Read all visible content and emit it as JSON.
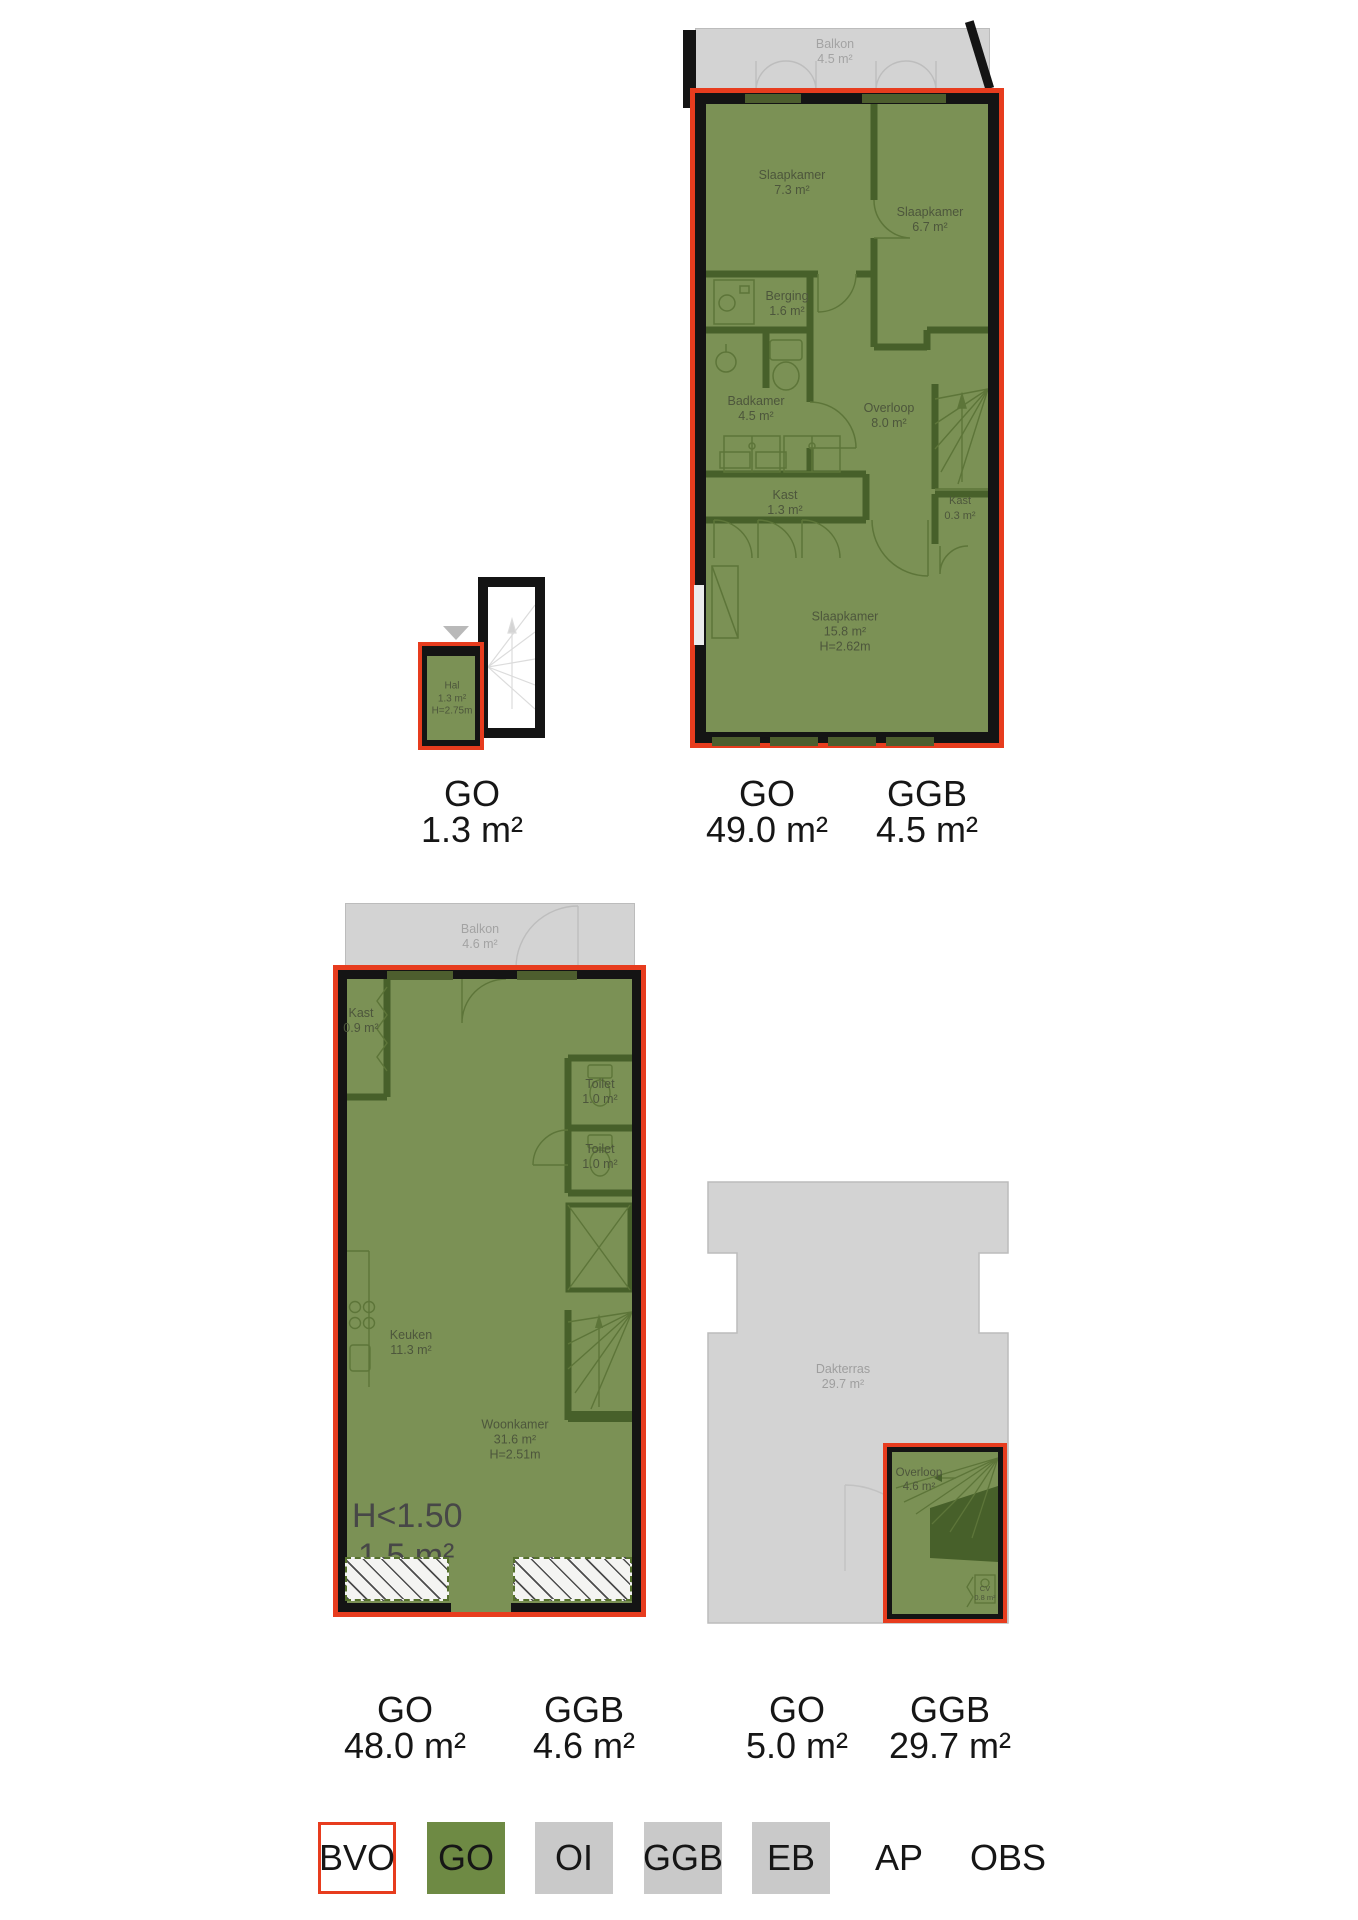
{
  "colors": {
    "bvo_outline_red": "#e73c1e",
    "go_green": "#6e8a44",
    "plan_green_fill": "#7b9155",
    "measure_gray": "#c9c9c9",
    "wall_black": "#141414"
  },
  "plan_hal": {
    "hal": {
      "name": "Hal",
      "area": "1.3 m²",
      "height": "H=2.75m"
    }
  },
  "plan_upper": {
    "balkon": {
      "name": "Balkon",
      "area": "4.5 m²"
    },
    "slaapkamer1": {
      "name": "Slaapkamer",
      "area": "7.3 m²"
    },
    "slaapkamer2": {
      "name": "Slaapkamer",
      "area": "6.7 m²"
    },
    "berging": {
      "name": "Berging",
      "area": "1.6 m²"
    },
    "badkamer": {
      "name": "Badkamer",
      "area": "4.5 m²"
    },
    "overloop": {
      "name": "Overloop",
      "area": "8.0 m²"
    },
    "kast1": {
      "name": "Kast",
      "area": "1.3 m²"
    },
    "kast2": {
      "name": "Kast",
      "area": "0.3 m²"
    },
    "slaapkamer3": {
      "name": "Slaapkamer",
      "area": "15.8 m²",
      "height": "H=2.62m"
    }
  },
  "plan_living": {
    "balkon": {
      "name": "Balkon",
      "area": "4.6 m²"
    },
    "kast": {
      "name": "Kast",
      "area": "0.9 m²"
    },
    "toilet1": {
      "name": "Toilet",
      "area": "1.0 m²"
    },
    "toilet2": {
      "name": "Toilet",
      "area": "1.0 m²"
    },
    "keuken": {
      "name": "Keuken",
      "area": "11.3 m²"
    },
    "woonkamer": {
      "name": "Woonkamer",
      "area": "31.6 m²",
      "height": "H=2.51m"
    },
    "low_height": {
      "name": "H<1.50",
      "area": "1.5 m²"
    }
  },
  "plan_roof": {
    "dakterras": {
      "name": "Dakterras",
      "area": "29.7 m²"
    },
    "overloop": {
      "name": "Overloop",
      "area": "4.6 m²"
    },
    "cv": {
      "name": "CV",
      "area": "0.8 m²"
    }
  },
  "area_labels": [
    {
      "code": "GO",
      "value": "1.3 m²"
    },
    {
      "code": "GO",
      "value": "49.0 m²"
    },
    {
      "code": "GGB",
      "value": "4.5 m²"
    },
    {
      "code": "GO",
      "value": "48.0 m²"
    },
    {
      "code": "GGB",
      "value": "4.6 m²"
    },
    {
      "code": "GO",
      "value": "5.0 m²"
    },
    {
      "code": "GGB",
      "value": "29.7 m²"
    }
  ],
  "legend": {
    "items": [
      {
        "label": "BVO",
        "swatch": "outline-red",
        "color": "#ffffff",
        "border": "#e73c1e"
      },
      {
        "label": "GO",
        "swatch": "green",
        "color": "#6e8a44"
      },
      {
        "label": "OI",
        "swatch": "gray",
        "color": "#c9c9c9"
      },
      {
        "label": "GGB",
        "swatch": "gray",
        "color": "#c9c9c9"
      },
      {
        "label": "EB",
        "swatch": "gray",
        "color": "#c9c9c9"
      },
      {
        "label": "AP",
        "swatch": "none"
      },
      {
        "label": "OBS",
        "swatch": "none"
      }
    ]
  }
}
